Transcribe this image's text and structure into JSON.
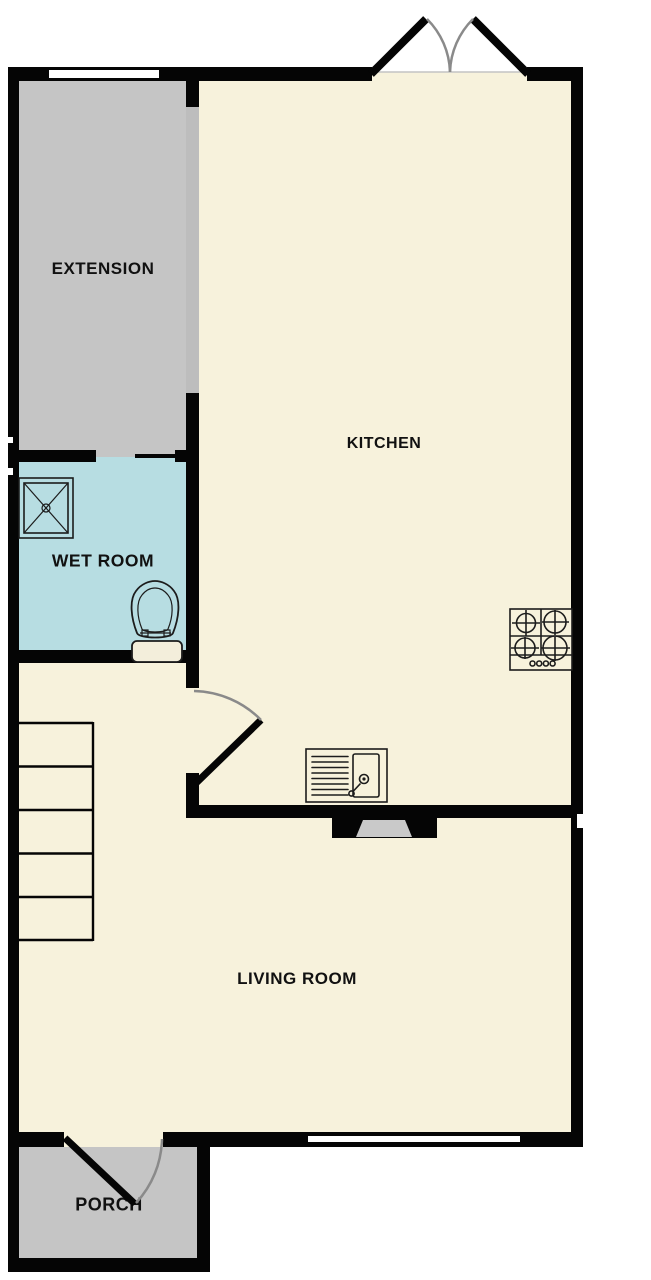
{
  "plan": {
    "colors": {
      "background": "#ffffff",
      "floor": "#f7f2dc",
      "annex": "#c5c5c5",
      "wetroom": "#b7dde2",
      "wall": "#050505",
      "divider": "#bdbdbd",
      "arc": "#8a8a8a",
      "line": "#1c1c1c",
      "label": "#111111",
      "cistern": "#f3eedb",
      "fireplace": "#c9c9c9"
    },
    "rooms": [
      {
        "id": "extension",
        "label": "EXTENSION"
      },
      {
        "id": "kitchen",
        "label": "KITCHEN"
      },
      {
        "id": "wet-room",
        "label": "WET ROOM"
      },
      {
        "id": "living-room",
        "label": "LIVING ROOM"
      },
      {
        "id": "porch",
        "label": "PORCH"
      }
    ],
    "fixtures": [
      "french-doors",
      "extension-window",
      "sliding-door",
      "shower-tray",
      "toilet",
      "staircase",
      "internal-door",
      "sink-drainer-unit",
      "gas-hob",
      "fireplace",
      "living-room-window",
      "front-door"
    ]
  }
}
